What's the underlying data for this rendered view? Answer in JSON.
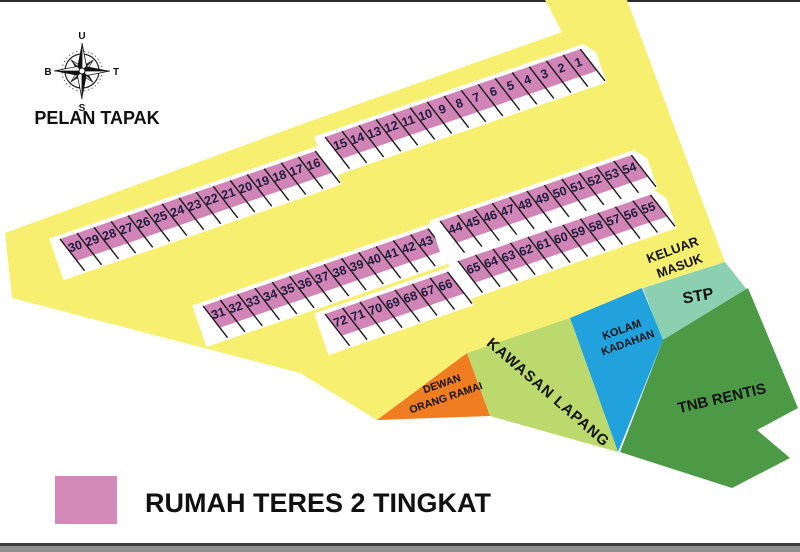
{
  "header": {
    "map_title": "PELAN TAPAK",
    "compass": {
      "north": "U",
      "east": "T",
      "south": "S",
      "west": "B"
    }
  },
  "legend": {
    "swatch_color": "#d489b8",
    "label": "RUMAH TERES 2 TINGKAT"
  },
  "colors": {
    "road": "#f6ef6f",
    "lot_pink": "#d184b6",
    "divider": "#1a1a1a",
    "page": "#ffffff",
    "border_dark": "#3c3c3c",
    "border_gray": "#909090"
  },
  "zones": [
    {
      "id": "keluar-masuk",
      "lines": [
        "KELUAR",
        "MASUK"
      ]
    },
    {
      "id": "stp",
      "label": "STP",
      "color": "#8bd0b0"
    },
    {
      "id": "kolam-kadahan",
      "lines": [
        "KOLAM",
        "KADAHAN"
      ],
      "color": "#21a2dc"
    },
    {
      "id": "kawasan-lapang",
      "label": "KAWASAN LAPANG",
      "color": "#bcd96e"
    },
    {
      "id": "dewan-orang-ramai",
      "lines": [
        "DEWAN",
        "ORANG RAMAI"
      ],
      "color": "#ef7d22"
    },
    {
      "id": "tnb-rentis",
      "label": "TNB RENTIS",
      "color": "#4d9a46"
    }
  ],
  "lots": {
    "fill": "#d184b6",
    "geom": {
      "angle": -19,
      "pinkH": 26,
      "lineH": 38,
      "stripTop": -4,
      "stripBot": 40,
      "pad": 10,
      "skew": 0.34
    },
    "rows": [
      {
        "name": "1-15",
        "numbers": [
          "15",
          "14",
          "13",
          "12",
          "11",
          "10",
          "9",
          "8",
          "7",
          "6",
          "5",
          "4",
          "3",
          "2",
          "1"
        ],
        "origin": [
          325,
          137
        ],
        "cellW": 18
      },
      {
        "name": "16-30",
        "numbers": [
          "30",
          "29",
          "28",
          "27",
          "26",
          "25",
          "24",
          "23",
          "22",
          "21",
          "20",
          "19",
          "18",
          "17",
          "16"
        ],
        "origin": [
          60,
          239
        ],
        "cellW": 18
      },
      {
        "name": "31-43",
        "numbers": [
          "31",
          "32",
          "33",
          "34",
          "35",
          "36",
          "37",
          "38",
          "39",
          "40",
          "41",
          "42",
          "43"
        ],
        "origin": [
          203,
          306
        ],
        "cellW": 18.3
      },
      {
        "name": "44-54",
        "numbers": [
          "44",
          "45",
          "46",
          "47",
          "48",
          "49",
          "50",
          "51",
          "52",
          "53",
          "54"
        ],
        "origin": [
          440,
          221
        ],
        "cellW": 18.4
      },
      {
        "name": "55-65",
        "numbers": [
          "65",
          "64",
          "63",
          "62",
          "61",
          "60",
          "59",
          "58",
          "57",
          "56",
          "55"
        ],
        "origin": [
          458,
          261
        ],
        "cellW": 18.5
      },
      {
        "name": "66-72",
        "numbers": [
          "72",
          "71",
          "70",
          "69",
          "68",
          "67",
          "66"
        ],
        "origin": [
          325,
          314
        ],
        "cellW": 18.5
      }
    ]
  }
}
